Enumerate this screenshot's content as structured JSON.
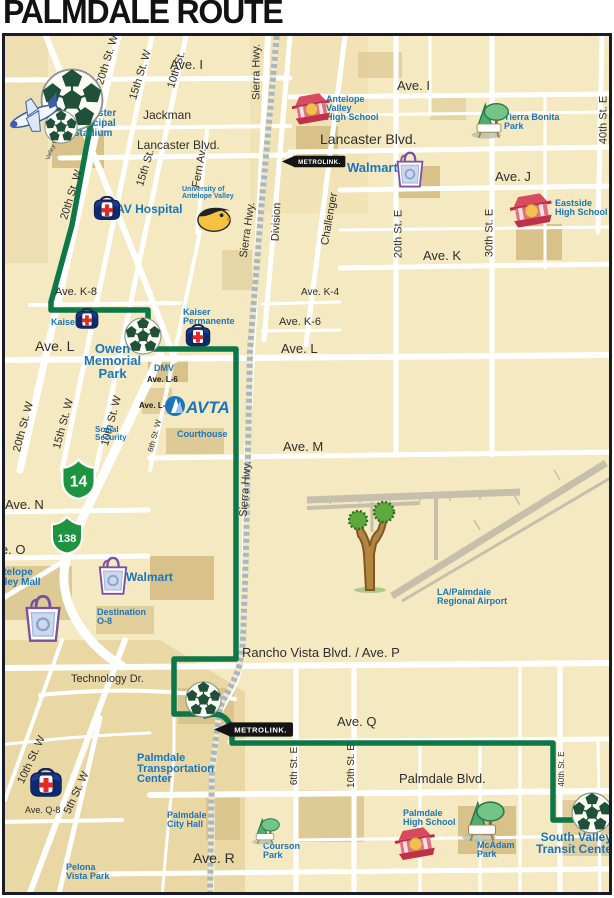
{
  "title": "PALMDALE ROUTE",
  "colors": {
    "route_green": "#0e7748",
    "landmark_blue": "#1b75bc",
    "street_label": "#2e2e2e",
    "map_cream": "#f5e9c1",
    "shield_green": "#1f9440",
    "metrolink_black": "#141414"
  },
  "route": {
    "name": "Palmdale Route",
    "color": "#0e7748",
    "stops": [
      "Lancaster Municipal Stadium",
      "Owen Memorial Park",
      "Palmdale Transportation Center",
      "South Valley Transit Center"
    ],
    "path_main": "M72 100 L97 90 L72 225 L51 302 L51 310 L148 310 L148 349 L236 349 L236 659 L174 659 L174 714 L200 714",
    "path_exit": "M205 716 C222 710 231 720 232 734 L232 743 L553 743 L553 820 L574 820 L589 814"
  },
  "street_labels": [
    {
      "t": "Ave. I",
      "x": 170,
      "y": 58,
      "s": 13
    },
    {
      "t": "Ave. I",
      "x": 397,
      "y": 79,
      "s": 13
    },
    {
      "t": "Jackman",
      "x": 143,
      "y": 109,
      "s": 12
    },
    {
      "t": "Lancaster Blvd.",
      "x": 137,
      "y": 139,
      "s": 12
    },
    {
      "t": "Lancaster Blvd.",
      "x": 320,
      "y": 132,
      "s": 14
    },
    {
      "t": "Ave. J",
      "x": 495,
      "y": 170,
      "s": 13
    },
    {
      "t": "Ave. K",
      "x": 423,
      "y": 249,
      "s": 13
    },
    {
      "t": "Ave. K-8",
      "x": 55,
      "y": 287,
      "s": 11
    },
    {
      "t": "Ave. K-4",
      "x": 301,
      "y": 288,
      "s": 10
    },
    {
      "t": "Ave. K-6",
      "x": 279,
      "y": 317,
      "s": 11
    },
    {
      "t": "Ave. L",
      "x": 35,
      "y": 339,
      "s": 14
    },
    {
      "t": "Ave. L",
      "x": 281,
      "y": 342,
      "s": 13
    },
    {
      "t": "Ave. M",
      "x": 283,
      "y": 440,
      "s": 13
    },
    {
      "t": "Ave. N",
      "x": 5,
      "y": 498,
      "s": 13
    },
    {
      "t": "Ave. O",
      "x": -14,
      "y": 543,
      "s": 13
    },
    {
      "t": "Rancho Vista Blvd. / Ave. P",
      "x": 242,
      "y": 646,
      "s": 13
    },
    {
      "t": "Technology Dr.",
      "x": 71,
      "y": 674,
      "s": 11
    },
    {
      "t": "Ave. Q",
      "x": 337,
      "y": 715,
      "s": 13
    },
    {
      "t": "Palmdale Blvd.",
      "x": 399,
      "y": 772,
      "s": 13
    },
    {
      "t": "Ave. Q-8",
      "x": 25,
      "y": 806,
      "s": 9
    },
    {
      "t": "Ave. R",
      "x": 193,
      "y": 851,
      "s": 14
    },
    {
      "t": "Ave. L-6",
      "x": 147,
      "y": 376,
      "s": 8,
      "b": 1
    },
    {
      "t": "Ave. L-8",
      "x": 139,
      "y": 402,
      "s": 8,
      "b": 1
    }
  ],
  "rotated_labels": [
    {
      "t": "20th St. W",
      "x": 108,
      "y": 60,
      "r": -73,
      "s": 11
    },
    {
      "t": "15th St. W",
      "x": 141,
      "y": 75,
      "r": -73,
      "s": 11
    },
    {
      "t": "10th St.",
      "x": 177,
      "y": 70,
      "r": -73,
      "s": 11
    },
    {
      "t": "Sierra Hwy.",
      "x": 257,
      "y": 72,
      "r": -90,
      "s": 11
    },
    {
      "t": "20th St. W",
      "x": 72,
      "y": 195,
      "r": -73,
      "s": 11
    },
    {
      "t": "15th St.",
      "x": 146,
      "y": 168,
      "r": -73,
      "s": 11
    },
    {
      "t": "Fern Av.",
      "x": 200,
      "y": 168,
      "r": -80,
      "s": 11
    },
    {
      "t": "Sierra Hwy.",
      "x": 248,
      "y": 230,
      "r": -82,
      "s": 11
    },
    {
      "t": "Division",
      "x": 277,
      "y": 222,
      "r": -87,
      "s": 11
    },
    {
      "t": "Challenger",
      "x": 330,
      "y": 219,
      "r": -80,
      "s": 11
    },
    {
      "t": "20th St. E",
      "x": 399,
      "y": 234,
      "r": -90,
      "s": 11
    },
    {
      "t": "30th St. E",
      "x": 490,
      "y": 233,
      "r": -90,
      "s": 11
    },
    {
      "t": "40th St. E",
      "x": 604,
      "y": 120,
      "r": -90,
      "s": 11
    },
    {
      "t": "20th St. W",
      "x": 24,
      "y": 427,
      "r": -75,
      "s": 11
    },
    {
      "t": "15th St. W",
      "x": 64,
      "y": 424,
      "r": -75,
      "s": 11
    },
    {
      "t": "10th St. W",
      "x": 112,
      "y": 421,
      "r": -75,
      "s": 11
    },
    {
      "t": "6th St. W",
      "x": 155,
      "y": 436,
      "r": -75,
      "s": 8
    },
    {
      "t": "Sierra Hwy.",
      "x": 246,
      "y": 489,
      "r": -86,
      "s": 11
    },
    {
      "t": "6th St. E",
      "x": 295,
      "y": 766,
      "r": -90,
      "s": 10
    },
    {
      "t": "10th St. E",
      "x": 352,
      "y": 766,
      "r": -90,
      "s": 10
    },
    {
      "t": "40th St. E",
      "x": 562,
      "y": 769,
      "r": -90,
      "s": 8
    },
    {
      "t": "10th St. W",
      "x": 32,
      "y": 760,
      "r": -65,
      "s": 11
    },
    {
      "t": "5th St. W",
      "x": 77,
      "y": 793,
      "r": -65,
      "s": 11
    },
    {
      "t": "Valley Central Wy",
      "x": 57,
      "y": 138,
      "r": -68,
      "s": 6
    }
  ],
  "landmarks": [
    {
      "lines": [
        "Lancaster",
        "Municipal",
        "Stadium"
      ],
      "x": 69,
      "y": 109,
      "s": 10,
      "c": 1
    },
    {
      "lines": [
        "AV Hospital"
      ],
      "x": 116,
      "y": 204,
      "s": 12
    },
    {
      "lines": [
        "University of",
        "Antelope Valley"
      ],
      "x": 182,
      "y": 187,
      "s": 7
    },
    {
      "lines": [
        "Antelope",
        "Valley",
        "High School"
      ],
      "x": 326,
      "y": 95,
      "s": 9
    },
    {
      "lines": [
        "Tierra Bonita",
        "Park"
      ],
      "x": 504,
      "y": 113,
      "s": 9
    },
    {
      "lines": [
        "Walmart"
      ],
      "x": 347,
      "y": 162,
      "s": 13
    },
    {
      "lines": [
        "Eastside",
        "High School"
      ],
      "x": 555,
      "y": 199,
      "s": 9
    },
    {
      "lines": [
        "Kaiser"
      ],
      "x": 51,
      "y": 318,
      "s": 9
    },
    {
      "lines": [
        "Kaiser",
        "Permanente"
      ],
      "x": 183,
      "y": 308,
      "s": 9
    },
    {
      "lines": [
        "Owen",
        "Memorial",
        "Park"
      ],
      "x": 84,
      "y": 343,
      "s": 13,
      "big": 1,
      "c": 1
    },
    {
      "lines": [
        "DMV"
      ],
      "x": 154,
      "y": 364,
      "s": 9
    },
    {
      "lines": [
        "Courthouse"
      ],
      "x": 177,
      "y": 430,
      "s": 9
    },
    {
      "lines": [
        "Social",
        "Security"
      ],
      "x": 95,
      "y": 426,
      "s": 8
    },
    {
      "lines": [
        "Antelope",
        "Valley Mall"
      ],
      "x": -10,
      "y": 568,
      "s": 10
    },
    {
      "lines": [
        "Walmart"
      ],
      "x": 126,
      "y": 572,
      "s": 12
    },
    {
      "lines": [
        "Destination",
        "O-8"
      ],
      "x": 97,
      "y": 608,
      "s": 9
    },
    {
      "lines": [
        "LA/Palmdale",
        "Regional Airport"
      ],
      "x": 437,
      "y": 588,
      "s": 9
    },
    {
      "lines": [
        "Palmdale",
        "Transportation",
        "Center"
      ],
      "x": 137,
      "y": 753,
      "s": 11,
      "big": 1
    },
    {
      "lines": [
        "Palmdale",
        "City Hall"
      ],
      "x": 167,
      "y": 811,
      "s": 9
    },
    {
      "lines": [
        "Courson",
        "Park"
      ],
      "x": 263,
      "y": 842,
      "s": 9
    },
    {
      "lines": [
        "Palmdale",
        "High School"
      ],
      "x": 403,
      "y": 809,
      "s": 9
    },
    {
      "lines": [
        "McAdam",
        "Park"
      ],
      "x": 477,
      "y": 841,
      "s": 9
    },
    {
      "lines": [
        "South Valley",
        "Transit Center"
      ],
      "x": 536,
      "y": 832,
      "s": 12,
      "big": 1,
      "c": 1
    },
    {
      "lines": [
        "Pelona",
        "Vista Park"
      ],
      "x": 66,
      "y": 863,
      "s": 9
    },
    {
      "lines": [
        "Palmdale",
        "Regional",
        "Medical",
        "Center"
      ],
      "x": -36,
      "y": 772,
      "s": 8
    }
  ],
  "icons": [
    {
      "type": "soccer",
      "x": 40,
      "y": 68,
      "d": 64
    },
    {
      "type": "soccer",
      "x": 44,
      "y": 110,
      "d": 34
    },
    {
      "type": "plane",
      "x": 6,
      "y": 90
    },
    {
      "type": "soccer",
      "x": 124,
      "y": 317,
      "d": 38
    },
    {
      "type": "soccer",
      "x": 185,
      "y": 681,
      "d": 37
    },
    {
      "type": "soccer",
      "x": 571,
      "y": 792,
      "d": 42
    },
    {
      "type": "hospital",
      "x": 92,
      "y": 196,
      "w": 30
    },
    {
      "type": "hospital",
      "x": 74,
      "y": 308,
      "w": 26
    },
    {
      "type": "hospital",
      "x": 184,
      "y": 324,
      "w": 28
    },
    {
      "type": "hospital",
      "x": 28,
      "y": 768,
      "w": 36
    },
    {
      "type": "school",
      "x": 291,
      "y": 92,
      "w": 42
    },
    {
      "type": "school",
      "x": 509,
      "y": 192,
      "w": 46
    },
    {
      "type": "school",
      "x": 394,
      "y": 826,
      "w": 44
    },
    {
      "type": "park",
      "x": 466,
      "y": 100,
      "w": 46
    },
    {
      "type": "park",
      "x": 248,
      "y": 816,
      "w": 34
    },
    {
      "type": "park",
      "x": 456,
      "y": 798,
      "w": 52
    },
    {
      "type": "bag",
      "x": 394,
      "y": 151,
      "w": 32
    },
    {
      "type": "bag",
      "x": 96,
      "y": 556,
      "w": 34
    },
    {
      "type": "bag",
      "x": 22,
      "y": 594,
      "w": 42
    },
    {
      "type": "eagle",
      "x": 196,
      "y": 201,
      "w": 36
    },
    {
      "type": "joshua",
      "x": 348,
      "y": 496
    },
    {
      "type": "avta",
      "x": 164,
      "y": 394,
      "label": "AVTA"
    }
  ],
  "shields": [
    {
      "num": "14",
      "x": 60,
      "y": 458,
      "w": 37,
      "h": 42,
      "fs": 17
    },
    {
      "num": "138",
      "x": 47,
      "y": 516,
      "w": 40,
      "h": 38,
      "fs": 13
    }
  ],
  "metrolink_signs": [
    {
      "label": "METROLINK.",
      "x": 281,
      "y": 153,
      "w": 66
    },
    {
      "label": "METROLINK.",
      "x": 213,
      "y": 719,
      "w": 82
    }
  ]
}
